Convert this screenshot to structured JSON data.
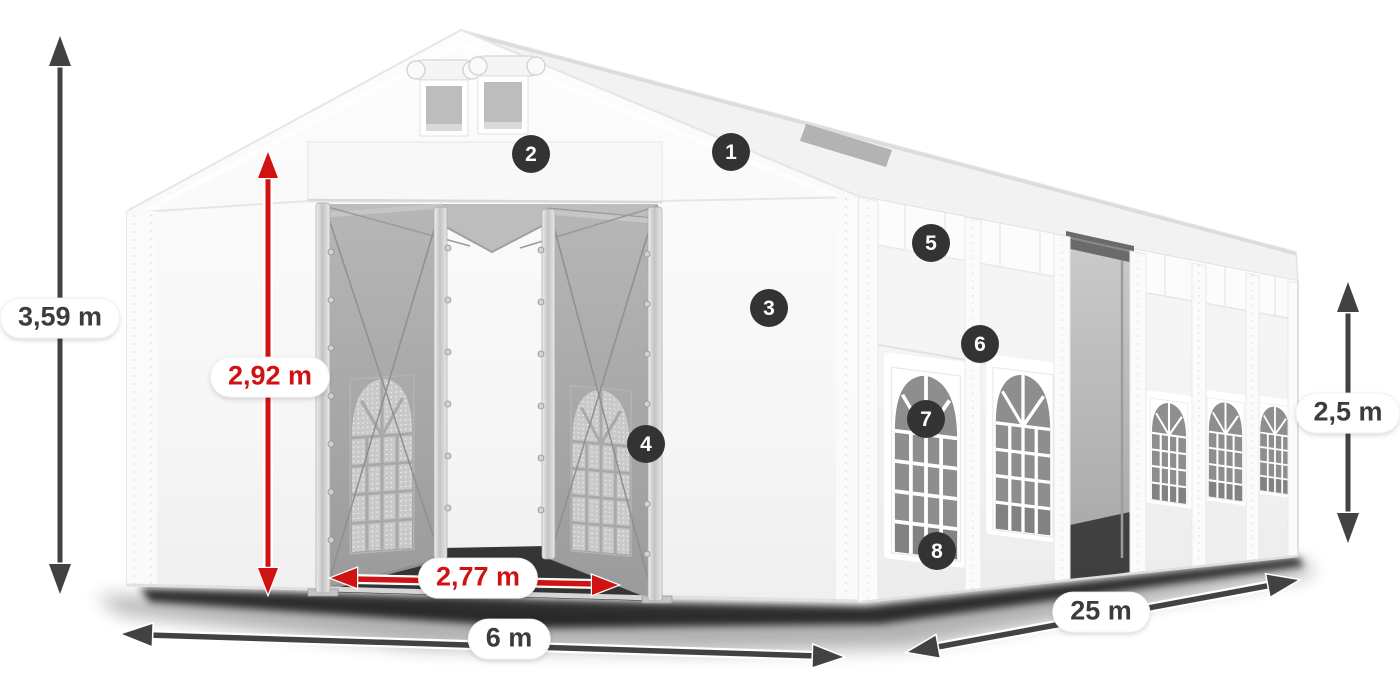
{
  "canvas": {
    "width": 1400,
    "height": 700,
    "background": "#ffffff"
  },
  "colors": {
    "accent_red": "#cf1212",
    "arrow_dark": "#424242",
    "badge_bg": "#333333",
    "badge_text": "#ffffff",
    "label_text": "#3c3c3c",
    "label_bg": "#ffffff"
  },
  "dimension_labels": {
    "total_height": {
      "text": "3,59 m"
    },
    "door_height": {
      "text": "2,92 m"
    },
    "door_width": {
      "text": "2,77 m"
    },
    "front_width": {
      "text": "6 m"
    },
    "side_length": {
      "text": "25 m"
    },
    "side_height": {
      "text": "2,5 m"
    }
  },
  "callout_badges": [
    {
      "number": "1"
    },
    {
      "number": "2"
    },
    {
      "number": "3"
    },
    {
      "number": "4"
    },
    {
      "number": "5"
    },
    {
      "number": "6"
    },
    {
      "number": "7"
    },
    {
      "number": "8"
    }
  ]
}
